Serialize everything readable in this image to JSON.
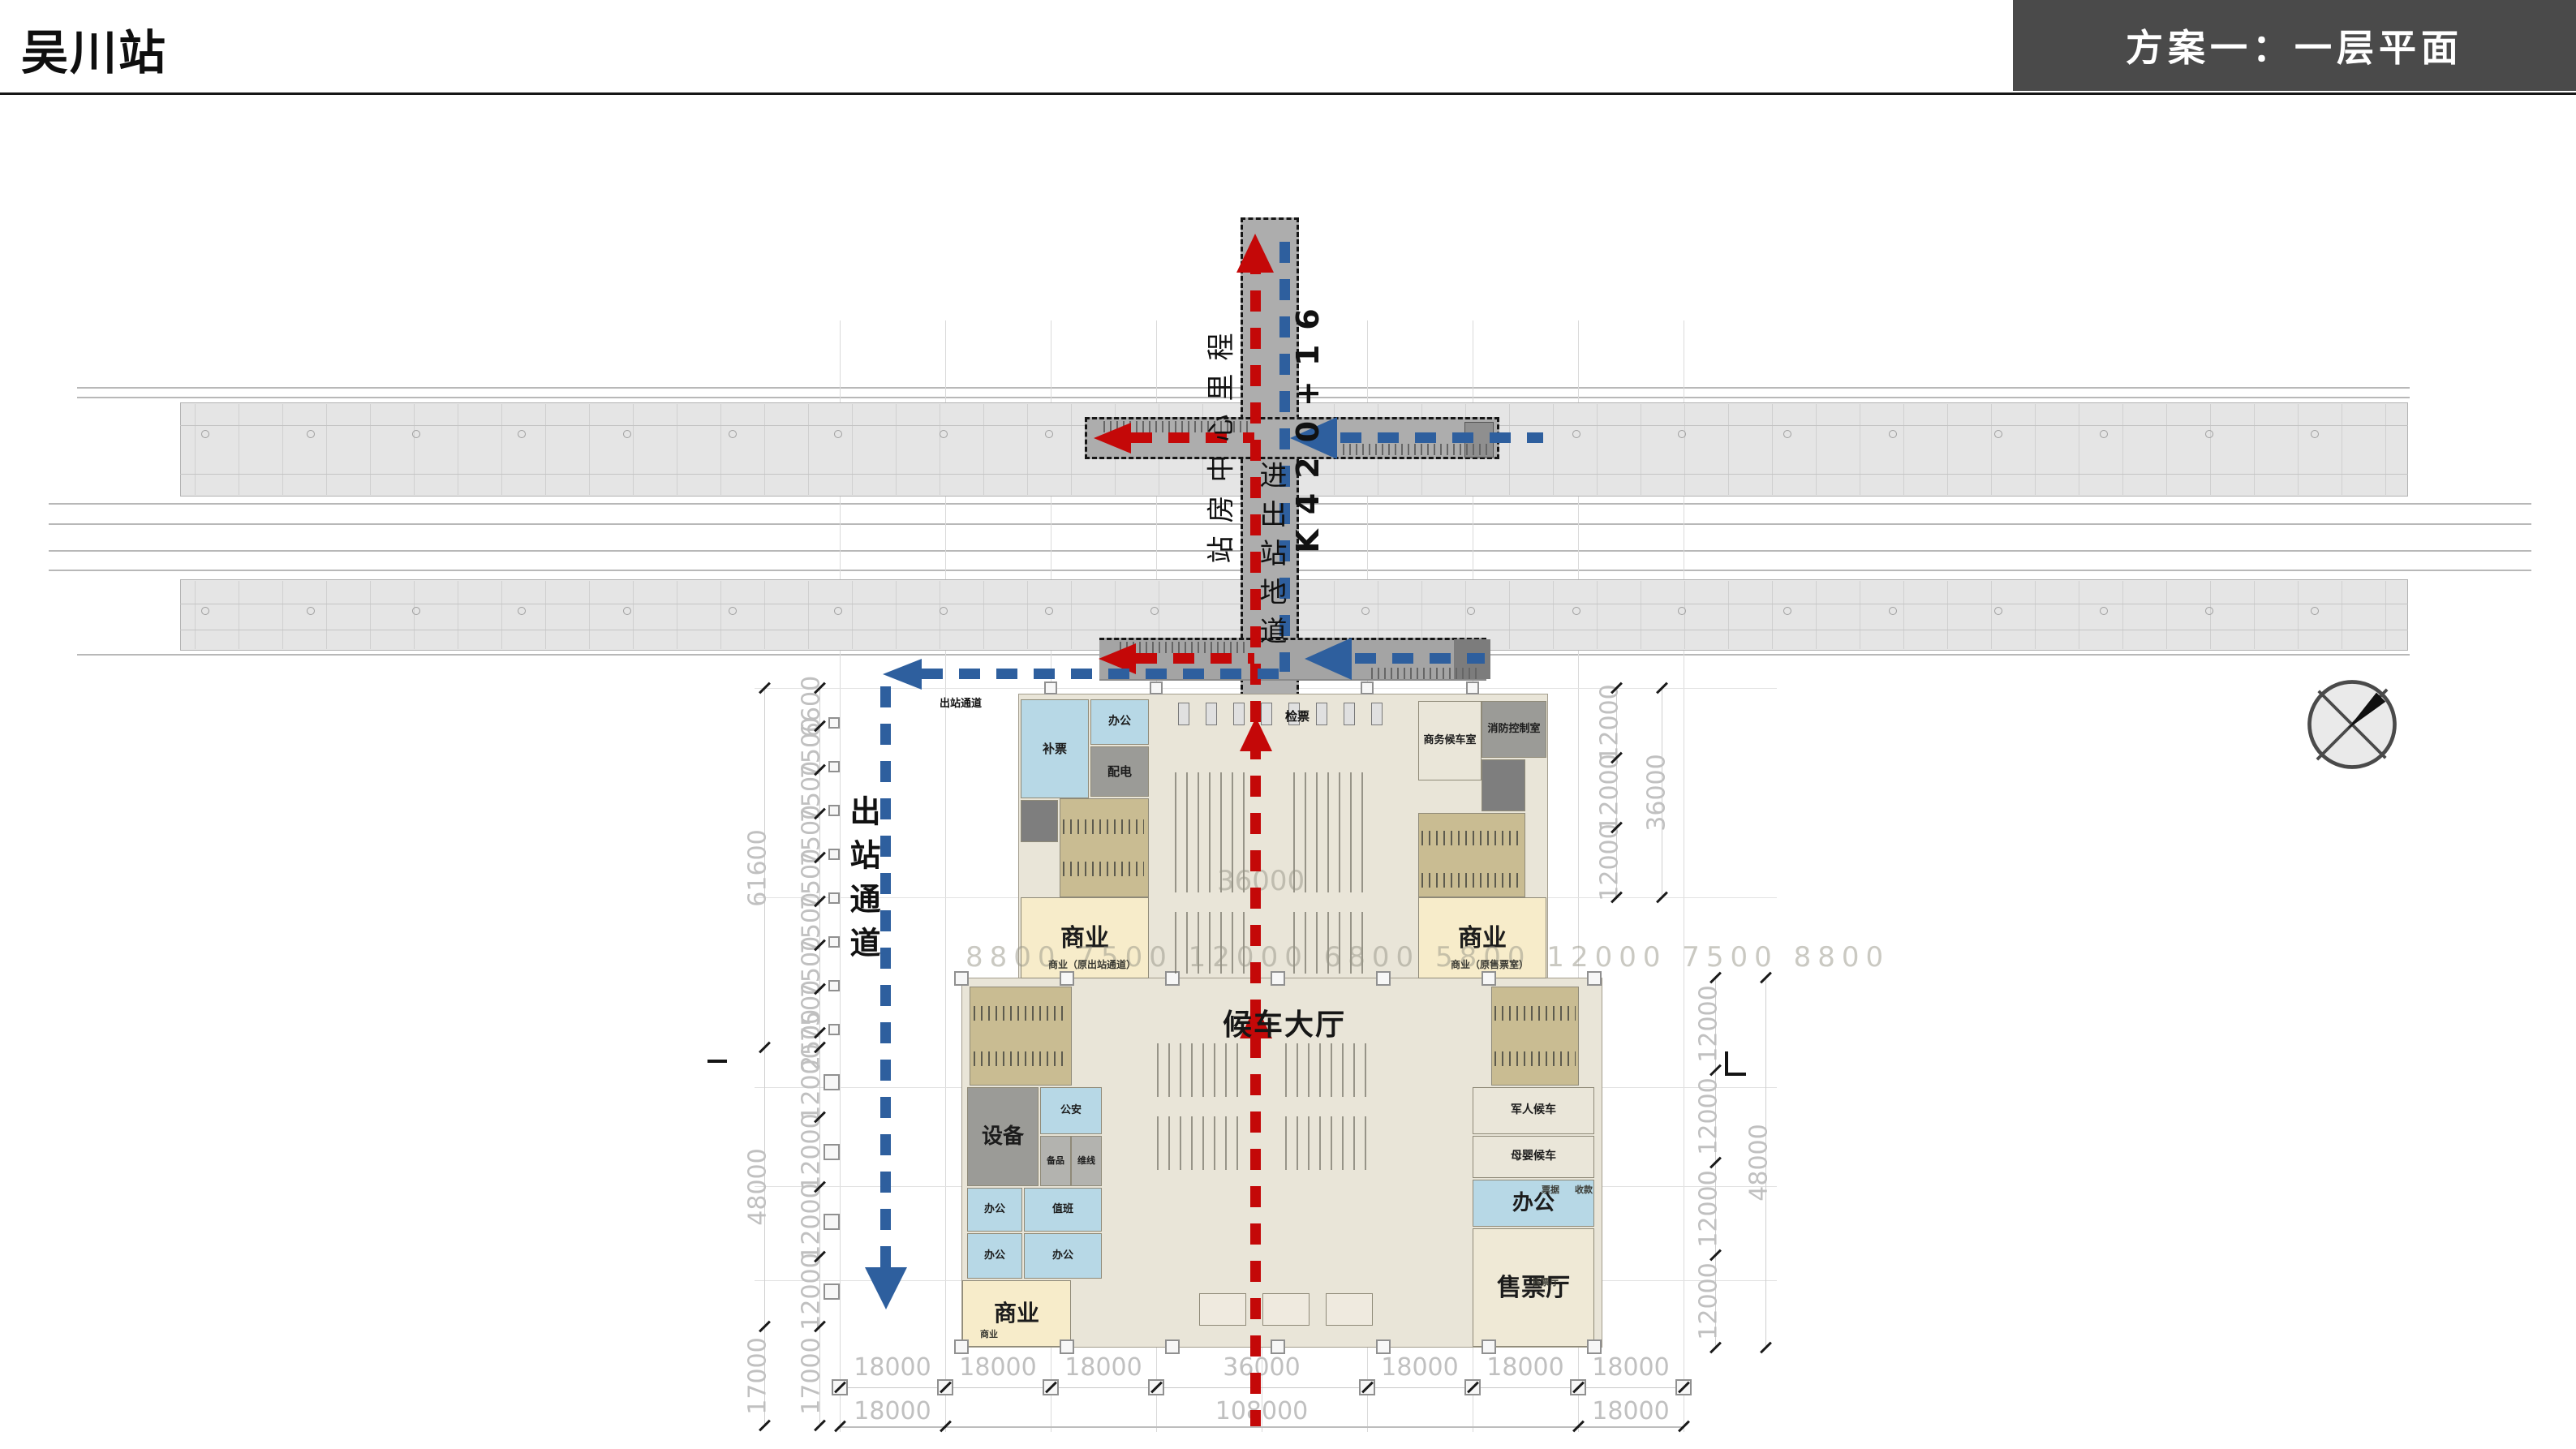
{
  "header": {
    "station_title": "吴川站",
    "scheme_title": "方案一：一层平面"
  },
  "legend_colors": {
    "inbound_red": "#c40808",
    "outbound_blue": "#2e5f9e"
  },
  "circulation": {
    "center_mileage_label": "站房中心里程",
    "mileage_value": "K420+16",
    "underpass_label": "进出站地道",
    "exit_passage_label": "出站通道",
    "exit_passage_small_label": "出站通道",
    "ticket_check_label": "检票"
  },
  "rooms": {
    "waiting_hall": "候车大厅",
    "bupiao": "补票",
    "office_small_ul": "办公",
    "peidian": "配电",
    "shangye_ul": "商业",
    "shangye_ul_sub": "商业（原出站通道）",
    "shangwu_waiting": "商务候车室",
    "fire_control": "消防控制室",
    "shangye_ur": "商业",
    "shangye_ur_sub": "商业（原售票室）",
    "equipment": "设备",
    "gongan": "公安",
    "beipin": "备品",
    "weixian": "维线",
    "office_a": "办公",
    "zhiban": "值班",
    "office_b": "办公",
    "office_c": "办公",
    "shangye_ll": "商业",
    "shangye_ll_sub": "商业",
    "military_waiting": "军人候车",
    "mother_infant_waiting": "母婴候车",
    "office_r": "办公",
    "piaoju": "票据",
    "shoukuan": "收款",
    "ticket_hall": "售票厅",
    "ticket_hall_sub": "售票厅"
  },
  "dims": {
    "bottom_row1": [
      "18000",
      "18000",
      "18000",
      "36000",
      "18000",
      "18000",
      "18000"
    ],
    "bottom_row2": [
      "18000",
      "108000",
      "18000"
    ],
    "left_inner": [
      "6600",
      "7500",
      "7500",
      "7500",
      "7500",
      "7500",
      "7500",
      "7500",
      "2500",
      "12000",
      "12000",
      "12000",
      "12000",
      "17000"
    ],
    "left_outer": [
      "61600",
      "48000",
      "17000"
    ],
    "right_upper_inner": [
      "12000",
      "12000",
      "12000"
    ],
    "right_upper_outer": [
      "36000"
    ],
    "right_lower_inner": [
      "12000",
      "12000",
      "12000",
      "12000"
    ],
    "right_lower_outer": [
      "48000"
    ],
    "ghost_row": "8800 7500 12000 6800 5800 12000 7500 8800",
    "ghost_center": "36000"
  }
}
